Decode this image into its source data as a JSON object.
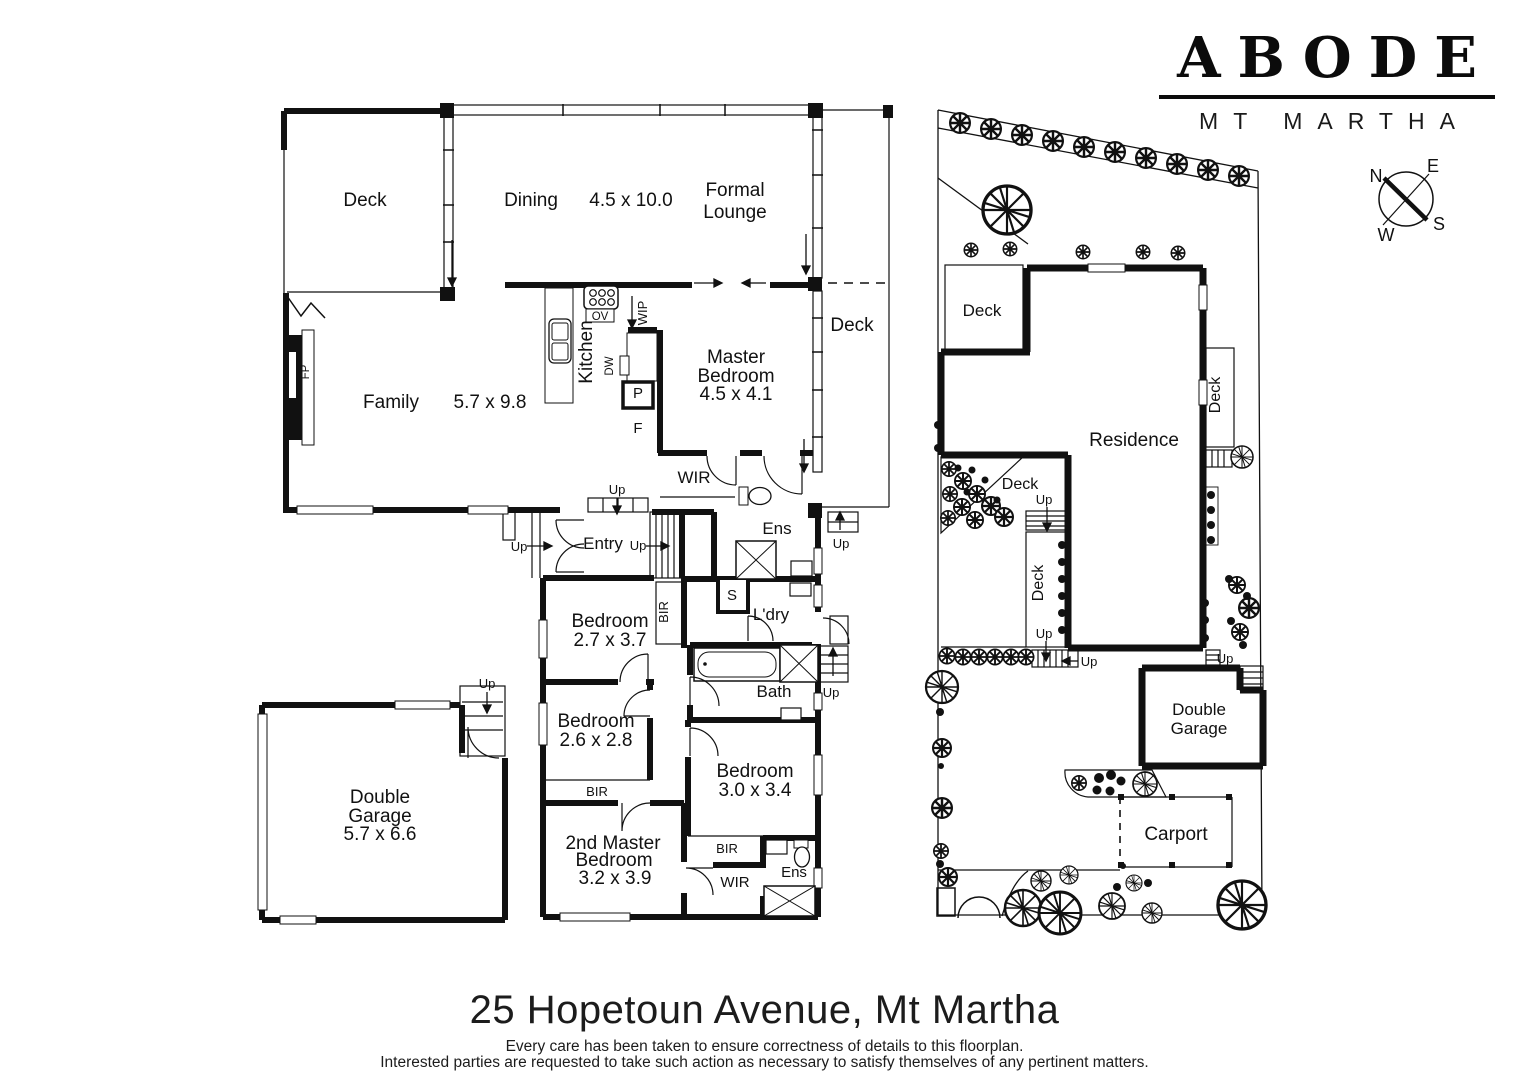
{
  "brand": {
    "name": "ABODE",
    "suburb": "MT MARTHA"
  },
  "compass": {
    "north": "N",
    "east": "E",
    "south": "S",
    "west": "W"
  },
  "labels": {
    "deck": "Deck",
    "up": "Up",
    "bir": "BIR",
    "wir": "WIR",
    "ens": "Ens",
    "fp": "FP",
    "s": "S",
    "p": "P",
    "f": "F",
    "ov": "OV",
    "dw": "DW",
    "wip": "WIP",
    "kitchen": "Kitchen",
    "dining": "Dining",
    "dining_dims": "4.5 x 10.0",
    "formal_1": "Formal",
    "formal_2": "Lounge",
    "family": "Family",
    "family_dims": "5.7 x 9.8",
    "master_1": "Master",
    "master_2": "Bedroom",
    "master_dims": "4.5 x 4.1",
    "entry": "Entry",
    "ldry": "L'dry",
    "bath": "Bath",
    "bedroom": "Bedroom",
    "bed1_dims": "2.7 x 3.7",
    "bed2_dims": "2.6 x 2.8",
    "bed3_dims": "3.0 x 3.4",
    "master2_1": "2nd Master",
    "master2_2": "Bedroom",
    "master2_dims": "3.2 x 3.9",
    "garage_1": "Double",
    "garage_2": "Garage",
    "garage_dims": "5.7 x 6.6",
    "residence": "Residence",
    "carport": "Carport"
  },
  "footer": {
    "address": "25 Hopetoun Avenue, Mt Martha",
    "disclaimer_1": "Every care has been taken to ensure correctness of details to this floorplan.",
    "disclaimer_2": "Interested parties are requested to take such action as necessary to satisfy themselves of any pertinent matters."
  }
}
